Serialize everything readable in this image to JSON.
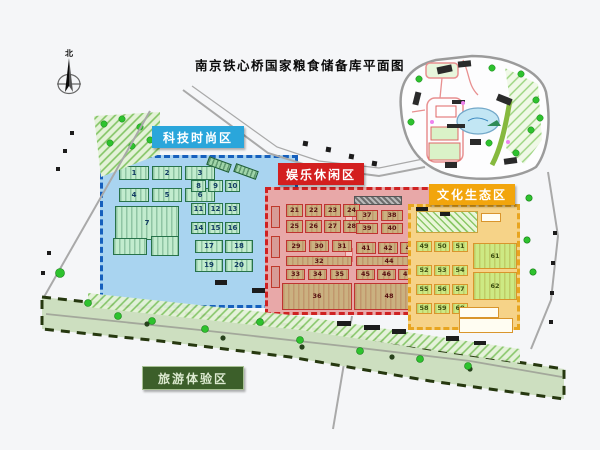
{
  "title": "南京铁心桥国家粮食储备库平面图",
  "compass": {
    "north_label": "北"
  },
  "zones": {
    "tech": {
      "label": "科技时尚区",
      "accent": "#2aa6db",
      "numbers": [
        "1",
        "2",
        "3",
        "4",
        "5",
        "6",
        "7",
        "8",
        "9",
        "10",
        "11",
        "12",
        "13",
        "14",
        "15",
        "16",
        "17",
        "18",
        "19",
        "20"
      ]
    },
    "leisure": {
      "label": "娱乐休闲区",
      "accent": "#d31f1f",
      "numbers": [
        "21",
        "22",
        "23",
        "24",
        "25",
        "26",
        "27",
        "28",
        "29",
        "30",
        "31",
        "32",
        "33",
        "34",
        "35",
        "36",
        "37",
        "38",
        "39",
        "40",
        "41",
        "42",
        "43",
        "44",
        "45",
        "46",
        "47",
        "48"
      ]
    },
    "culture": {
      "label": "文化生态区",
      "accent": "#f2a50c",
      "numbers": [
        "49",
        "50",
        "51",
        "52",
        "53",
        "54",
        "55",
        "56",
        "57",
        "58",
        "59",
        "60",
        "61",
        "62"
      ]
    },
    "tourism": {
      "label": "旅游体验区",
      "accent": "#3c5f2a"
    }
  }
}
